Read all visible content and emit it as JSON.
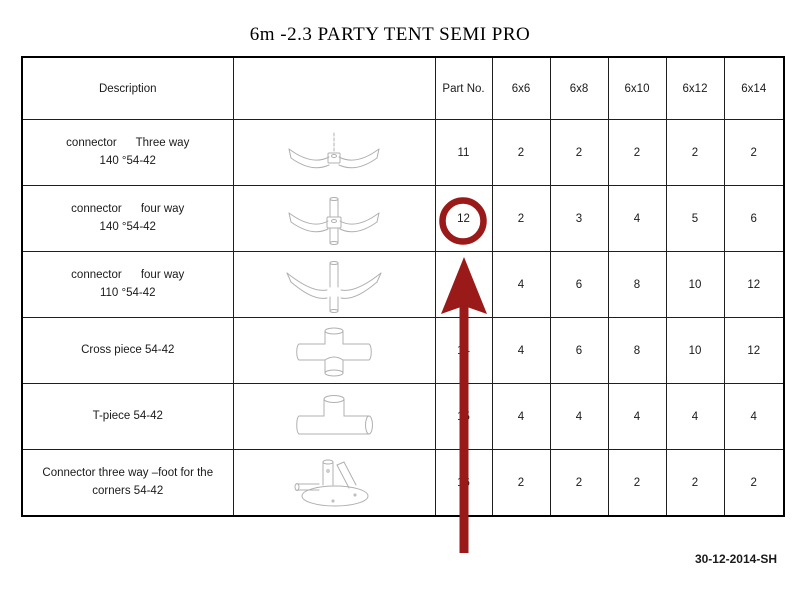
{
  "title": "6m -2.3 PARTY TENT SEMI PRO",
  "footer": "30-12-2014-SH",
  "annotation": {
    "color": "#9a1a1a",
    "highlighted_part_no": "12"
  },
  "table": {
    "headers": [
      "Description",
      "",
      "Part No.",
      "6x6",
      "6x8",
      "6x10",
      "6x12",
      "6x14"
    ],
    "rows": [
      {
        "description": "connector      Three way\n140 °54-42",
        "icon": "three-way-connector-140",
        "part_no": "11",
        "qty": [
          "2",
          "2",
          "2",
          "2",
          "2"
        ]
      },
      {
        "description": "connector      four way\n140 °54-42",
        "icon": "four-way-connector-140",
        "part_no": "12",
        "qty": [
          "2",
          "3",
          "4",
          "5",
          "6"
        ]
      },
      {
        "description": "connector      four way\n110 °54-42",
        "icon": "four-way-connector-110",
        "part_no": "",
        "qty": [
          "4",
          "6",
          "8",
          "10",
          "12"
        ]
      },
      {
        "description": "Cross piece 54-42",
        "icon": "cross-piece",
        "part_no": "14",
        "qty": [
          "4",
          "6",
          "8",
          "10",
          "12"
        ]
      },
      {
        "description": "T-piece 54-42",
        "icon": "t-piece",
        "part_no": "15",
        "qty": [
          "4",
          "4",
          "4",
          "4",
          "4"
        ]
      },
      {
        "description": "Connector three way –foot for the\ncorners 54-42",
        "icon": "foot-connector",
        "part_no": "16",
        "qty": [
          "2",
          "2",
          "2",
          "2",
          "2"
        ]
      }
    ]
  }
}
